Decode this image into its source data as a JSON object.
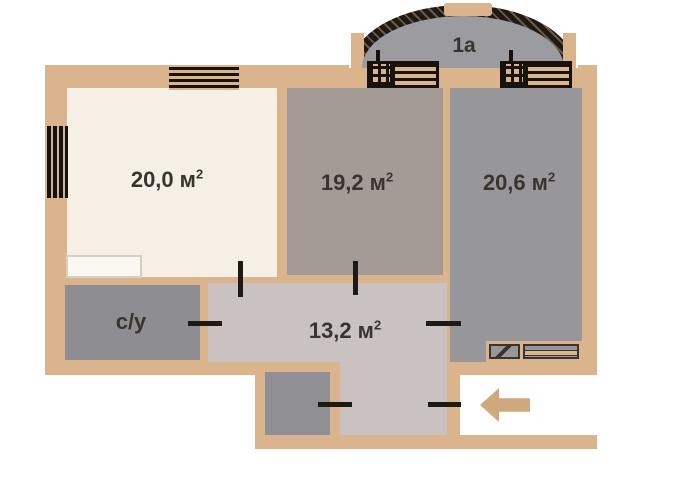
{
  "plan": {
    "balcony": {
      "label": "1a"
    },
    "rooms": {
      "living": {
        "area": "20,0",
        "unit": "м",
        "sup": "2"
      },
      "middle": {
        "area": "19,2",
        "unit": "м",
        "sup": "2"
      },
      "right": {
        "area": "20,6",
        "unit": "м",
        "sup": "2"
      },
      "hall": {
        "area": "13,2",
        "unit": "м",
        "sup": "2"
      },
      "bathroom": {
        "label": "с/у"
      }
    },
    "colors": {
      "wall": "#d9b48d",
      "room_living": "#f5efe6",
      "room_middle": "#a49a96",
      "room_right": "#97969a",
      "hall": "#c9c2c0",
      "bathroom": "#8e8d91",
      "closet": "#908f93",
      "balcony": "#9c9ba0",
      "outline": "#1f1915",
      "text": "#3a3430",
      "arrow": "#cfa87e"
    }
  }
}
